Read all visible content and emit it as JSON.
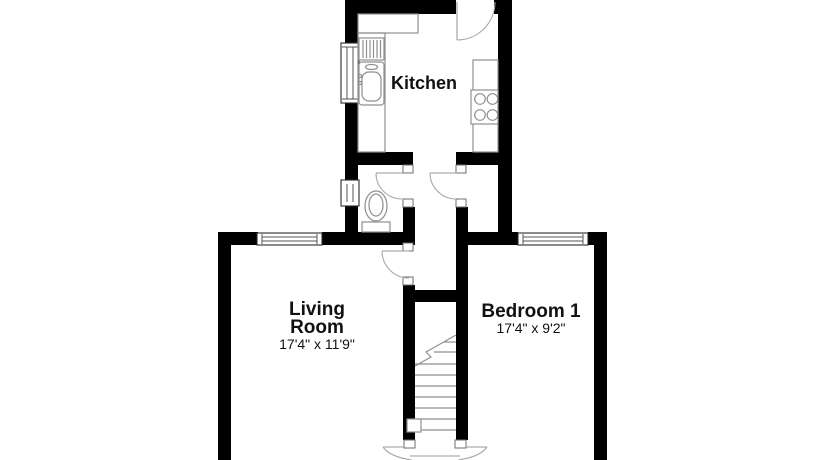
{
  "floor_plan": {
    "rooms": {
      "kitchen": {
        "label": "Kitchen"
      },
      "living_room": {
        "label_line1": "Living",
        "label_line2": "Room",
        "dimensions": "17'4\" x 11'9\""
      },
      "bedroom_1": {
        "label": "Bedroom 1",
        "dimensions": "17'4\" x 9'2\""
      }
    },
    "colors": {
      "wall": "#000000",
      "background": "#ffffff",
      "fixture_line": "#8f8f8f"
    }
  }
}
